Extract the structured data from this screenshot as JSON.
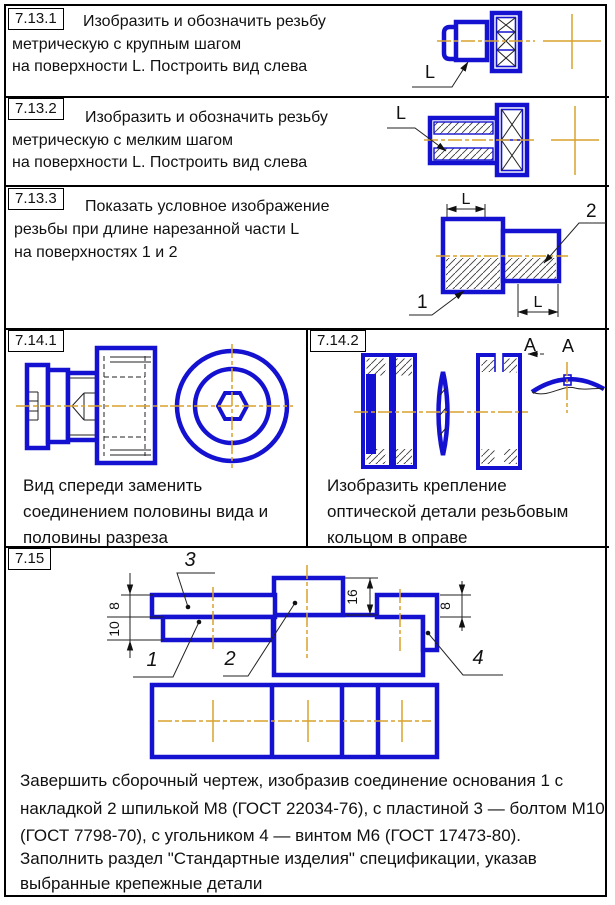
{
  "colors": {
    "line_blue": "#1412d0",
    "centerline_orange": "#d9a22c",
    "frame_black": "#000000"
  },
  "panels": {
    "t1": {
      "num": "7.13.1",
      "l1": "Изобразить и обозначить резьбу",
      "l2": "метрическую с крупным шагом",
      "l3": "на поверхности L. Построить вид слева",
      "lab_L": "L"
    },
    "t2": {
      "num": "7.13.2",
      "l1": "Изобразить и обозначить резьбу",
      "l2": "метрическую с мелким шагом",
      "l3": "на поверхности L. Построить вид слева",
      "lab_L": "L"
    },
    "t3": {
      "num": "7.13.3",
      "l1": "Показать условное изображение",
      "l2": "резьбы при длине нарезанной части L",
      "l3": "на поверхностях 1 и 2",
      "dim_L_top": "L",
      "dim_L_bot": "L",
      "lab_1": "1",
      "lab_2": "2"
    },
    "t4": {
      "num": "7.14.1",
      "l1": "Вид спереди заменить",
      "l2": "соединением половины вида и",
      "l3": "половины разреза"
    },
    "t5": {
      "num": "7.14.2",
      "l1": "Изобразить крепление",
      "l2": "оптической детали резьбовым",
      "l3": "кольцом в оправе",
      "lab_A1": "A",
      "lab_A2": "A"
    },
    "t6": {
      "num": "7.15",
      "lab_1": "1",
      "lab_2": "2",
      "lab_3": "3",
      "lab_4": "4",
      "dim_8_left": "8",
      "dim_10": "10",
      "dim_16": "16",
      "dim_8_right": "8",
      "p1": "Завершить сборочный чертеж, изобразив соединение основания 1 с",
      "p2": "накладкой 2 шпилькой М8 (ГОСТ 22034-76), с пластиной 3  — болтом М10",
      "p3": "(ГОСТ 7798-70),  с угольником 4  — винтом М6 (ГОСТ 17473-80).",
      "p4": "Заполнить раздел \"Стандартные изделия\"  спецификации, указав",
      "p5": "выбранные крепежные детали"
    }
  }
}
